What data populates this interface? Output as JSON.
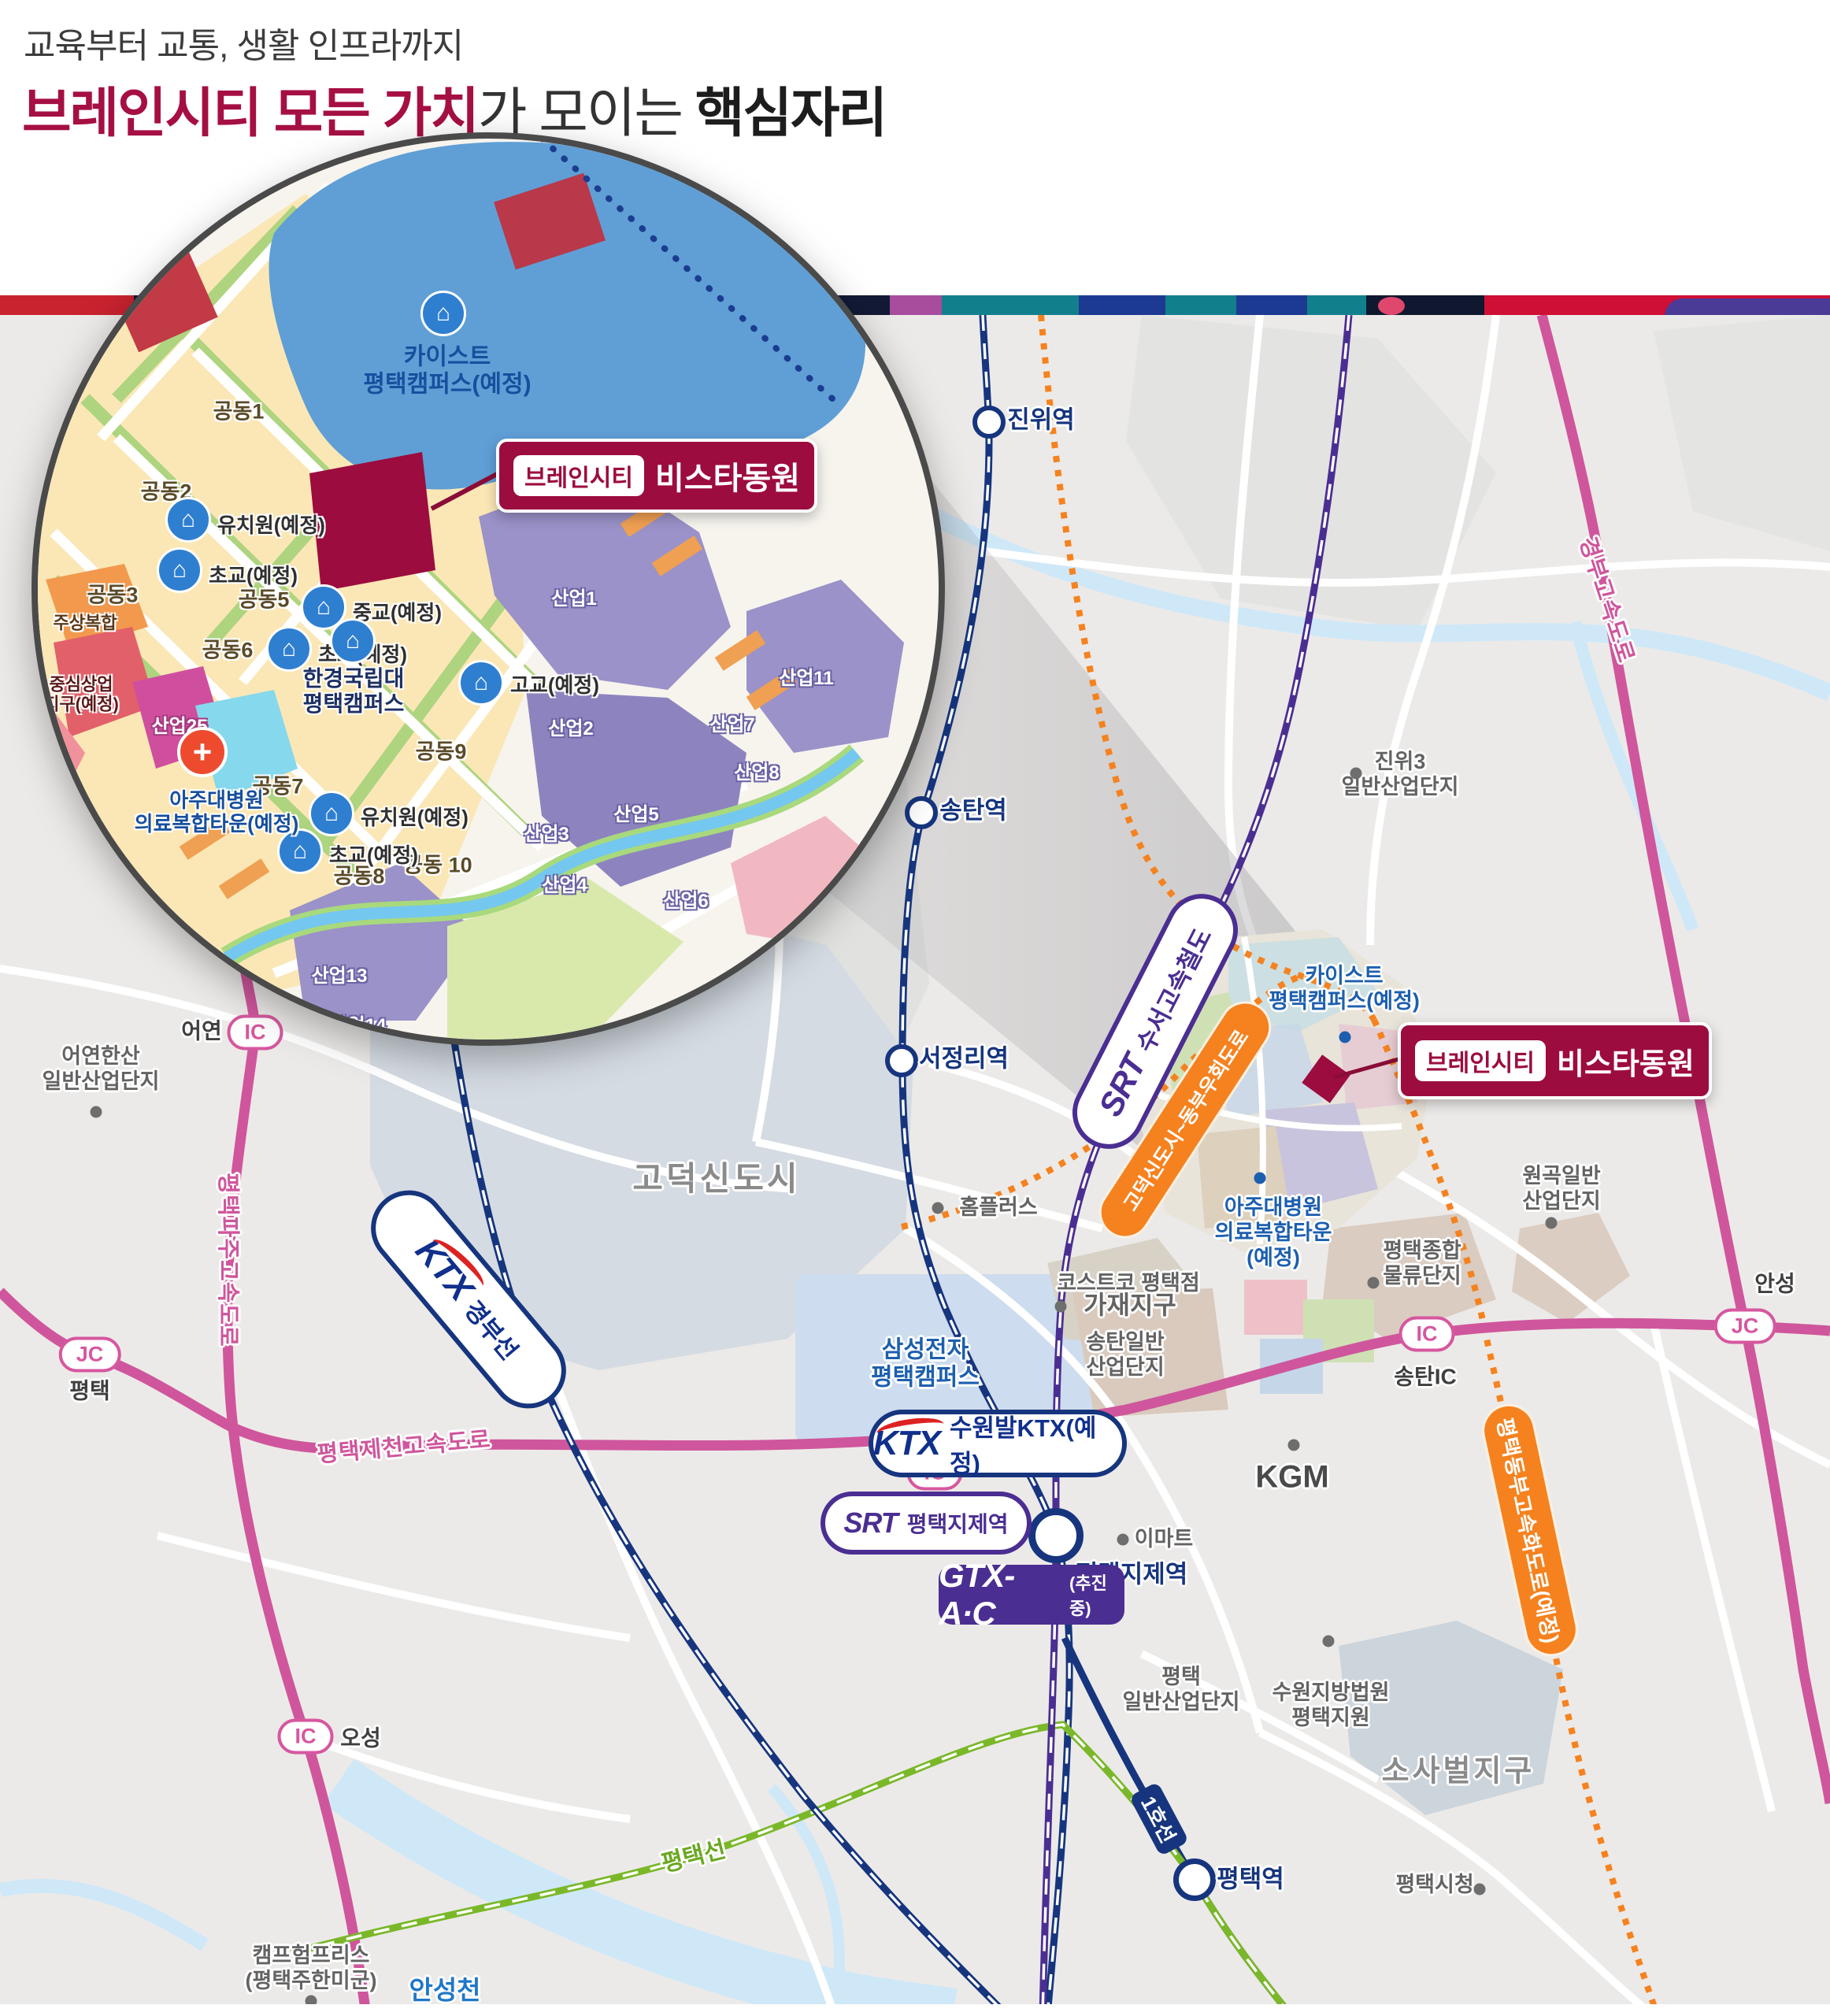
{
  "header": {
    "subtitle": "교육부터 교통, 생활 인프라까지",
    "title_accent": "브레인시티 모든 가치",
    "title_mid": "가 모이는 ",
    "title_bold": "핵심자리"
  },
  "callout": {
    "chip": "브레인시티",
    "name": "비스타동원"
  },
  "inset": {
    "kaist": "카이스트\n평택캠퍼스(예정)",
    "univ": "한경국립대\n평택캠퍼스",
    "hospital": "아주대병원\n의료복합타운(예정)",
    "mixed_use": "주상복합",
    "commercial": "중심상업\n지구(예정)",
    "kindergarten": "유치원(예정)",
    "elementary": "초교(예정)",
    "middle": "중교(예정)",
    "high": "고교(예정)",
    "blocks": [
      "공동1",
      "공동2",
      "공동3",
      "공동5",
      "공동6",
      "공동7",
      "공동8",
      "공동9",
      "공동 10"
    ],
    "industrial": [
      "산업1",
      "산업2",
      "산업3",
      "산업4",
      "산업5",
      "산업6",
      "산업7",
      "산업8",
      "산업11",
      "산업13",
      "산업14",
      "산업25"
    ]
  },
  "map": {
    "stations": [
      "진위역",
      "송탄역",
      "서정리역",
      "평택지제역",
      "평택역"
    ],
    "badges": [
      {
        "type": "IC",
        "name": "어연"
      },
      {
        "type": "JC",
        "name": "평택"
      },
      {
        "type": "IC",
        "name": "평택고덕"
      },
      {
        "type": "IC",
        "name": "오성"
      },
      {
        "type": "IC",
        "name": "송탄IC"
      },
      {
        "type": "JC",
        "name": "안성"
      }
    ],
    "roads": [
      "평택파주고속도로",
      "평택제천고속도로",
      "경부고속도로",
      "평택동부고속화도로(예정)",
      "고덕신도시~동부우회도로"
    ],
    "rails": {
      "srt_logo": "SRT",
      "ktx_logo": "KTX",
      "gtx_logo": "GTX-A·C",
      "srt_line": "수서고속철도",
      "gyeongbu_line": "경부선",
      "suwon_ktx": "수원발KTX(예정)",
      "jije_srt": "평택지제역",
      "gtx_status": "(추진중)",
      "line1": "1호선",
      "pt_line": "평택선"
    },
    "areas": [
      "고덕신도시",
      "가재지구",
      "소사벌지구",
      "삼성전자\n평택캠퍼스",
      "송탄일반\n산업단지",
      "평택\n일반산업단지",
      "진위3\n일반산업단지",
      "어연한산\n일반산업단지",
      "원곡일반\n산업단지",
      "평택종합\n물류단지",
      "수원지방법원\n평택지원",
      "캠프험프리스\n(평택주한미군)"
    ],
    "pois": [
      "홈플러스",
      "코스트코 평택점",
      "KGM",
      "이마트",
      "평택시청"
    ],
    "facilities": {
      "kaist": "카이스트\n평택캠퍼스(예정)",
      "ajou": "아주대병원\n의료복합타운\n(예정)"
    },
    "river": "안성천"
  }
}
